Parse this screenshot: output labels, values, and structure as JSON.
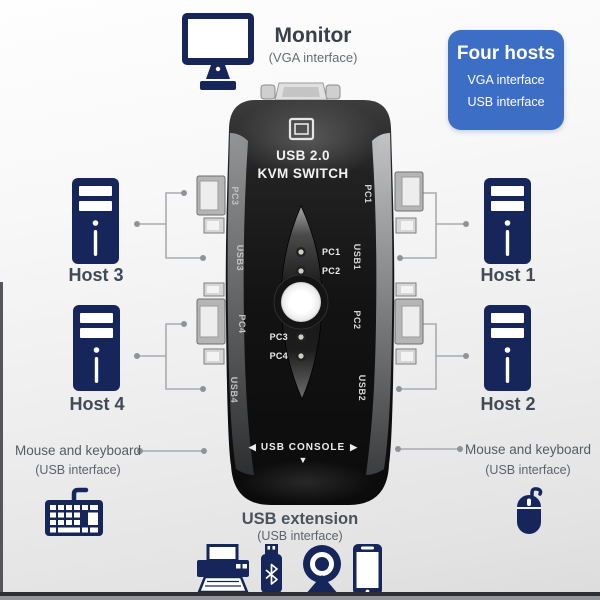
{
  "palette": {
    "icon_navy": "#16265a",
    "badge_blue": "#3d6ec5",
    "device_black": "#121212",
    "connector_gray": "#a8abaf",
    "text_dark": "#39404a",
    "text_gray": "#565c63"
  },
  "monitor": {
    "label": "Monitor",
    "interface": "(VGA interface)"
  },
  "badge": {
    "title": "Four hosts",
    "lines": [
      "VGA interface",
      "USB interface"
    ]
  },
  "device": {
    "model_line1": "USB 2.0",
    "model_line2": "KVM SWITCH",
    "left_port_labels": [
      "PC3",
      "USB3",
      "PC4",
      "USB4"
    ],
    "right_port_labels": [
      "PC1",
      "USB1",
      "PC2",
      "USB2"
    ],
    "leds": {
      "top": [
        "PC1",
        "PC2"
      ],
      "bottom": [
        "PC3",
        "PC4"
      ]
    },
    "console": {
      "left_arrow": "◀",
      "label": "USB CONSOLE",
      "right_arrow": "▶",
      "down_arrow": "▼"
    }
  },
  "hosts": {
    "host1": "Host 1",
    "host2": "Host 2",
    "host3": "Host 3",
    "host4": "Host 4"
  },
  "peripherals": {
    "left": {
      "title": "Mouse and keyboard",
      "interface": "(USB interface)"
    },
    "right": {
      "title": "Mouse and keyboard",
      "interface": "(USB interface)"
    },
    "usb_extension": {
      "title": "USB extension",
      "interface": "(USB interface)"
    }
  }
}
